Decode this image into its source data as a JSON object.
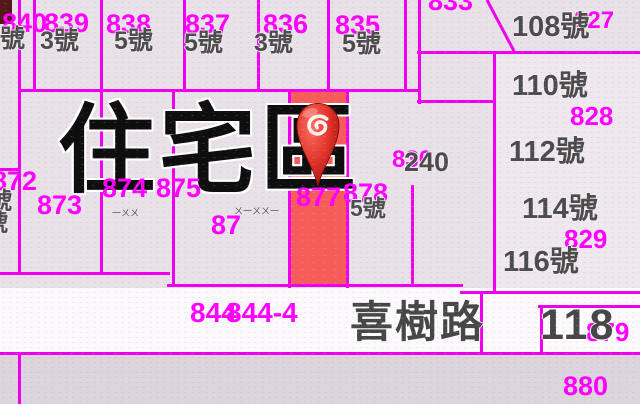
{
  "map": {
    "zone_label": "住宅區",
    "road": {
      "street": "喜樹路",
      "number": "118"
    },
    "selected_parcel": {
      "lot": "877",
      "fill": "#f65c5a"
    },
    "colors": {
      "background": "#e8e1e8",
      "parcel_line": "#ee00ee",
      "lot_label": "#ff00ff",
      "house_label": "#4c4c4c",
      "road_band": "#fbf9fb",
      "selected_fill": "#f65c5a",
      "pin_red": "#d93025"
    },
    "zone_pos": {
      "x": 58,
      "y": 102,
      "size": 97
    },
    "road_pos": {
      "street_x": 350,
      "street_y": 302,
      "number_x": 540,
      "number_y": 304,
      "size": 43
    },
    "pin": {
      "x": 292,
      "y": 98,
      "w": 52,
      "h": 94
    },
    "regions": [
      {
        "name": "road-band",
        "x": 0,
        "y": 288,
        "w": 640,
        "h": 65,
        "c": "#fbf9fb",
        "inter": "false"
      },
      {
        "name": "south-band",
        "x": 0,
        "y": 353,
        "w": 640,
        "h": 51,
        "c": "#ddd5dd",
        "inter": "false"
      },
      {
        "name": "east-parcels",
        "x": 497,
        "y": 55,
        "w": 143,
        "h": 233,
        "c": "#efe8ef",
        "inter": "false"
      },
      {
        "name": "selected-parcel",
        "x": 290,
        "y": 90,
        "w": 57,
        "h": 197,
        "c": "#f65c5a",
        "inter": "true"
      },
      {
        "name": "edge-artifact",
        "x": 0,
        "y": 0,
        "w": 12,
        "h": 24,
        "c": "#551718",
        "inter": "false"
      }
    ],
    "lines": [
      {
        "o": "v",
        "x": 18,
        "y": 0,
        "len": 274
      },
      {
        "o": "v",
        "x": 33,
        "y": 0,
        "len": 90
      },
      {
        "o": "v",
        "x": 100,
        "y": 0,
        "len": 274
      },
      {
        "o": "v",
        "x": 183,
        "y": 0,
        "len": 90
      },
      {
        "o": "v",
        "x": 257,
        "y": 0,
        "len": 90
      },
      {
        "o": "v",
        "x": 327,
        "y": 0,
        "len": 90
      },
      {
        "o": "v",
        "x": 404,
        "y": 0,
        "len": 90
      },
      {
        "o": "v",
        "x": 418,
        "y": 0,
        "len": 104
      },
      {
        "o": "v",
        "x": 172,
        "y": 89,
        "len": 197
      },
      {
        "o": "v",
        "x": 288,
        "y": 89,
        "len": 199
      },
      {
        "o": "v",
        "x": 346,
        "y": 89,
        "len": 199
      },
      {
        "o": "v",
        "x": 411,
        "y": 185,
        "len": 101
      },
      {
        "o": "v",
        "x": 493,
        "y": 51,
        "len": 241
      },
      {
        "o": "v",
        "x": 480,
        "y": 292,
        "len": 62
      },
      {
        "o": "v",
        "x": 540,
        "y": 305,
        "len": 48
      },
      {
        "o": "v",
        "x": 18,
        "y": 352,
        "len": 52
      },
      {
        "o": "h",
        "x": 18,
        "y": 89,
        "len": 400
      },
      {
        "o": "h",
        "x": 417,
        "y": 51,
        "len": 223
      },
      {
        "o": "h",
        "x": 417,
        "y": 100,
        "len": 79
      },
      {
        "o": "h",
        "x": 0,
        "y": 168,
        "len": 20
      },
      {
        "o": "h",
        "x": 0,
        "y": 272,
        "len": 170
      },
      {
        "o": "h",
        "x": 167,
        "y": 284,
        "len": 296
      },
      {
        "o": "h",
        "x": 460,
        "y": 291,
        "len": 180
      },
      {
        "o": "h",
        "x": 538,
        "y": 305,
        "len": 102
      },
      {
        "o": "h",
        "x": 0,
        "y": 352,
        "len": 640
      }
    ],
    "diagonal": {
      "x1": 487,
      "y1": 0,
      "x2": 514,
      "y2": 51
    },
    "lot_labels": [
      {
        "t": "840",
        "x": 2,
        "y": 10,
        "s": 27
      },
      {
        "t": "839",
        "x": 44,
        "y": 10,
        "s": 27
      },
      {
        "t": "838",
        "x": 106,
        "y": 11,
        "s": 27
      },
      {
        "t": "837",
        "x": 185,
        "y": 11,
        "s": 27
      },
      {
        "t": "836",
        "x": 263,
        "y": 11,
        "s": 27
      },
      {
        "t": "835",
        "x": 335,
        "y": 12,
        "s": 27
      },
      {
        "t": "833",
        "x": 428,
        "y": -12,
        "s": 27
      },
      {
        "t": "827",
        "x": 574,
        "y": 9,
        "s": 24
      },
      {
        "t": "828",
        "x": 570,
        "y": 103,
        "s": 26
      },
      {
        "t": "829",
        "x": 564,
        "y": 226,
        "s": 26
      },
      {
        "t": "830",
        "x": 392,
        "y": 148,
        "s": 24
      },
      {
        "t": "872",
        "x": -8,
        "y": 168,
        "s": 27
      },
      {
        "t": "873",
        "x": 37,
        "y": 192,
        "s": 27
      },
      {
        "t": "874",
        "x": 102,
        "y": 175,
        "s": 27
      },
      {
        "t": "875",
        "x": 156,
        "y": 175,
        "s": 27
      },
      {
        "t": "87",
        "x": 211,
        "y": 212,
        "s": 27
      },
      {
        "t": "877",
        "x": 296,
        "y": 184,
        "s": 27
      },
      {
        "t": "878",
        "x": 343,
        "y": 180,
        "s": 27
      },
      {
        "t": "844",
        "x": 190,
        "y": 299,
        "s": 28
      },
      {
        "t": "844-4",
        "x": 226,
        "y": 299,
        "s": 28
      },
      {
        "t": "879",
        "x": 586,
        "y": 319,
        "s": 26
      },
      {
        "t": "880",
        "x": 563,
        "y": 373,
        "s": 27
      }
    ],
    "house_labels": [
      {
        "t": "號",
        "x": 0,
        "y": 27,
        "s": 25
      },
      {
        "t": "3號",
        "x": 40,
        "y": 29,
        "s": 25
      },
      {
        "t": "5號",
        "x": 114,
        "y": 29,
        "s": 25
      },
      {
        "t": "5號",
        "x": 184,
        "y": 31,
        "s": 25
      },
      {
        "t": "3號",
        "x": 254,
        "y": 31,
        "s": 25
      },
      {
        "t": "5號",
        "x": 342,
        "y": 32,
        "s": 25
      },
      {
        "t": "108號",
        "x": 512,
        "y": 13,
        "s": 29
      },
      {
        "t": "110號",
        "x": 512,
        "y": 72,
        "s": 29
      },
      {
        "t": "112號",
        "x": 509,
        "y": 138,
        "s": 29
      },
      {
        "t": "114號",
        "x": 522,
        "y": 195,
        "s": 29
      },
      {
        "t": "116號",
        "x": 503,
        "y": 248,
        "s": 29
      },
      {
        "t": "240",
        "x": 404,
        "y": 149,
        "s": 27
      },
      {
        "t": "5號",
        "x": 350,
        "y": 197,
        "s": 23
      },
      {
        "t": "號",
        "x": -12,
        "y": 190,
        "s": 24
      },
      {
        "t": "號",
        "x": -16,
        "y": 212,
        "s": 24
      }
    ],
    "small_marks": [
      {
        "t": "一ㄨㄨ",
        "x": 112,
        "y": 209,
        "s": 9
      },
      {
        "t": "ㄨ一ㄨㄨ一",
        "x": 234,
        "y": 207,
        "s": 9
      }
    ]
  }
}
